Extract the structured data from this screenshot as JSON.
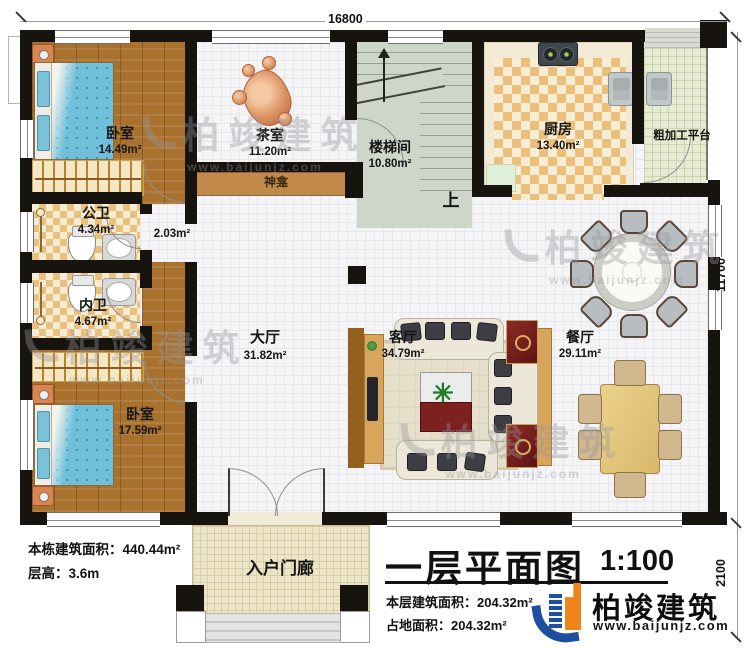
{
  "plan": {
    "dim_top": "16800",
    "dim_right": "11700",
    "dim_right_lower": "2100",
    "up": "上",
    "rooms": {
      "bedroom1": {
        "name": "卧室",
        "area": "14.49m²"
      },
      "tea": {
        "name": "茶室",
        "area": "11.20m²"
      },
      "stair": {
        "name": "楼梯间",
        "area": "10.80m²"
      },
      "kitchen": {
        "name": "厨房",
        "area": "13.40m²"
      },
      "platform": {
        "name": "粗加工平台"
      },
      "shrine": {
        "name": "神龛"
      },
      "pubbath": {
        "name": "公卫",
        "area": "4.34m²"
      },
      "passage": {
        "area": "2.03m²"
      },
      "privbath": {
        "name": "内卫",
        "area": "4.67m²"
      },
      "hall": {
        "name": "大厅",
        "area": "31.82m²"
      },
      "living": {
        "name": "客厅",
        "area": "34.79m²"
      },
      "dining": {
        "name": "餐厅",
        "area": "29.11m²"
      },
      "bedroom2": {
        "name": "卧室",
        "area": "17.59m²"
      },
      "porch": {
        "name": "入户门廊"
      }
    }
  },
  "notes": {
    "building_area": "本栋建筑面积：440.44m²",
    "floor_height": "层高：3.6m"
  },
  "title_block": {
    "title": "一层平面图",
    "scale": "1:100",
    "floor_area": "本层建筑面积：204.32m²",
    "footprint_area": "占地面积：204.32m²"
  },
  "brand": {
    "name": "柏竣建筑",
    "website": "www.baijunjz.com"
  },
  "watermark": {
    "name": "柏竣建筑",
    "website": "www.baijunjz.com"
  },
  "colors": {
    "wall": "#17130e",
    "wood_floor": "#a9712e",
    "shrine_shelf": "#c28a4a",
    "brand_blue": "#1d4f9e",
    "brand_orange": "#f08419"
  }
}
